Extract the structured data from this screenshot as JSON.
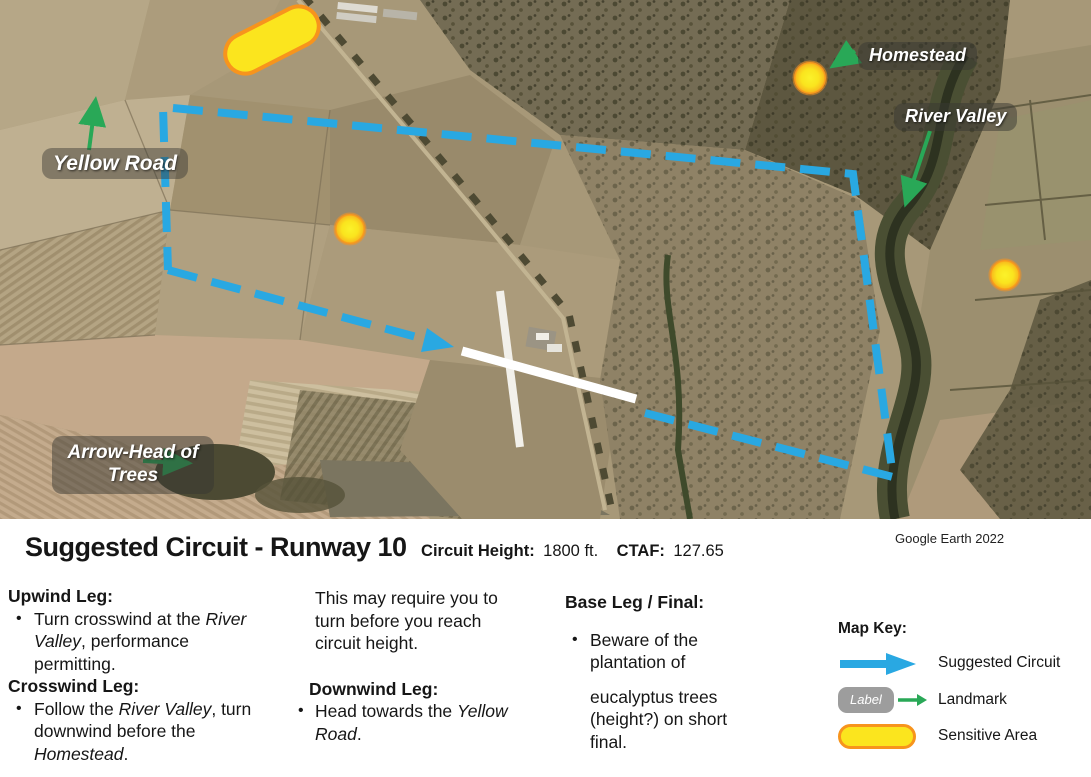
{
  "map": {
    "labels": {
      "yellow_road": "Yellow Road",
      "homestead": "Homestead",
      "river_valley": "River Valley",
      "arrowhead_trees": "Arrow-Head of Trees"
    },
    "attribution": "Google Earth 2022",
    "colors": {
      "circuit_blue": "#29A8E2",
      "landmark_green": "#29A857",
      "sensitive_yellow": "#FBE51E",
      "sensitive_border": "#F7941D"
    }
  },
  "title": {
    "main": "Suggested Circuit - Runway 10",
    "circuit_height_label": "Circuit Height:",
    "circuit_height_value": "1800 ft.",
    "ctaf_label": "CTAF:",
    "ctaf_value": "127.65"
  },
  "legs": {
    "upwind": {
      "heading": "Upwind Leg:",
      "bullet_pre": "Turn crosswind at the ",
      "bullet_em": "River Valley",
      "bullet_post": ", performance permitting."
    },
    "crosswind": {
      "heading": "Crosswind Leg:",
      "bullet_pre": "Follow the ",
      "bullet_em": "River Valley",
      "bullet_mid": ", turn downwind before the ",
      "bullet_em2": "Homestead",
      "bullet_post": "."
    },
    "note": "This may require you to turn before you reach circuit height.",
    "downwind": {
      "heading": "Downwind Leg:",
      "bullet_pre": "Head towards the ",
      "bullet_em": "Yellow Road",
      "bullet_post": "."
    },
    "base": {
      "heading": "Base Leg / Final:",
      "bullet_line1": "Beware of the plantation of",
      "bullet_line2": "eucalyptus trees (height?) on short final."
    }
  },
  "map_key": {
    "heading": "Map Key:",
    "suggested_circuit": "Suggested Circuit",
    "landmark": "Landmark",
    "landmark_pill": "Label",
    "sensitive_area": "Sensitive Area"
  }
}
